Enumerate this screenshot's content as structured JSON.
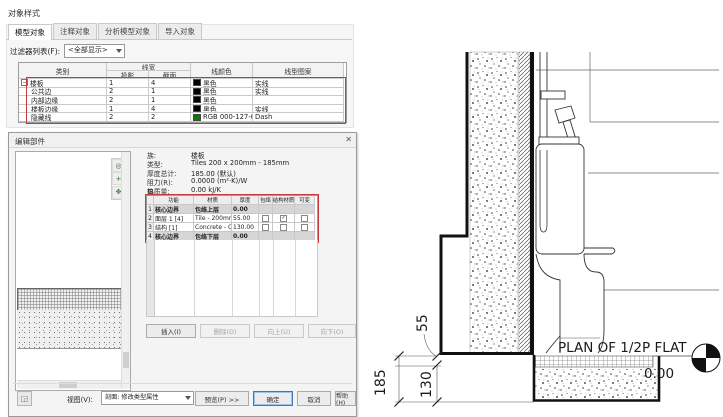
{
  "object_styles": {
    "title": "对象样式",
    "tabs": [
      {
        "label": "模型对象"
      },
      {
        "label": "注释对象"
      },
      {
        "label": "分析模型对象"
      },
      {
        "label": "导入对象"
      }
    ],
    "filter_label": "过滤器列表(F):",
    "filter_value": "<全部显示>",
    "headers": {
      "category": "类别",
      "line_weight": "线宽",
      "projection": "投影",
      "section": "截面",
      "line_color": "线颜色",
      "line_pattern": "线型图案"
    },
    "rows": [
      {
        "tree": "−",
        "category": "楼板",
        "projection": "1",
        "section": "4",
        "color_name": "黑色",
        "color_hex": "#000000",
        "pattern": "实线"
      },
      {
        "tree": "",
        "category": "公共边",
        "projection": "2",
        "section": "1",
        "color_name": "黑色",
        "color_hex": "#000000",
        "pattern": "实线"
      },
      {
        "tree": "",
        "category": "内部边缘",
        "projection": "2",
        "section": "1",
        "color_name": "黑色",
        "color_hex": "#000000",
        "pattern": ""
      },
      {
        "tree": "",
        "category": "楼板边缘",
        "projection": "1",
        "section": "4",
        "color_name": "黑色",
        "color_hex": "#000000",
        "pattern": "实线"
      },
      {
        "tree": "",
        "category": "隐藏线",
        "projection": "2",
        "section": "2",
        "color_name": "RGB 000-127-000",
        "color_hex": "#007f00",
        "pattern": "Dash"
      }
    ],
    "highlight_color": "#c53b3b"
  },
  "edit_assembly": {
    "title": "编辑部件",
    "close_glyph": "✕",
    "info": [
      {
        "label": "族:",
        "value": "楼板"
      },
      {
        "label": "类型:",
        "value": "Tiles 200 x 200mm - 185mm"
      },
      {
        "label": "厚度总计:",
        "value": "185.00 (默认)"
      },
      {
        "label": "阻力(R):",
        "value": "0.0000 (m²·K)/W"
      },
      {
        "label": "热质量:",
        "value": "0.00 kJ/K"
      }
    ],
    "layers_label": "层",
    "table": {
      "headers": [
        "功能",
        "材质",
        "厚度",
        "包络",
        "结构材质",
        "可变"
      ],
      "rows": [
        {
          "num": "1",
          "function": "核心边界",
          "material": "包络上层",
          "thickness": "0.00"
        },
        {
          "num": "2",
          "function": "面层 1 [4]",
          "material": "Tile - 200mm x",
          "thickness": "55.00",
          "wraps": "",
          "structural": "✓",
          "variable": ""
        },
        {
          "num": "3",
          "function": "结构 [1]",
          "material": "Concrete - Cast",
          "thickness": "130.00",
          "wraps": "",
          "structural": "",
          "variable": ""
        },
        {
          "num": "4",
          "function": "核心边界",
          "material": "包络下层",
          "thickness": "0.00"
        }
      ]
    },
    "buttons": {
      "insert": "插入(I)",
      "delete": "删除(D)",
      "up": "向上(U)",
      "down": "向下(O)"
    },
    "bottom": {
      "view_label": "视图(V):",
      "view_value": "剖面: 修改类型属性",
      "preview": "预览(P)  >>",
      "ok": "确定",
      "cancel": "取消",
      "help": "帮助(H)"
    }
  },
  "drawing": {
    "plan_label": "PLAN OF 1/2P FLAT",
    "level_value": "0.00",
    "dim_tile": "55",
    "dim_total": "185",
    "dim_slab": "130"
  }
}
